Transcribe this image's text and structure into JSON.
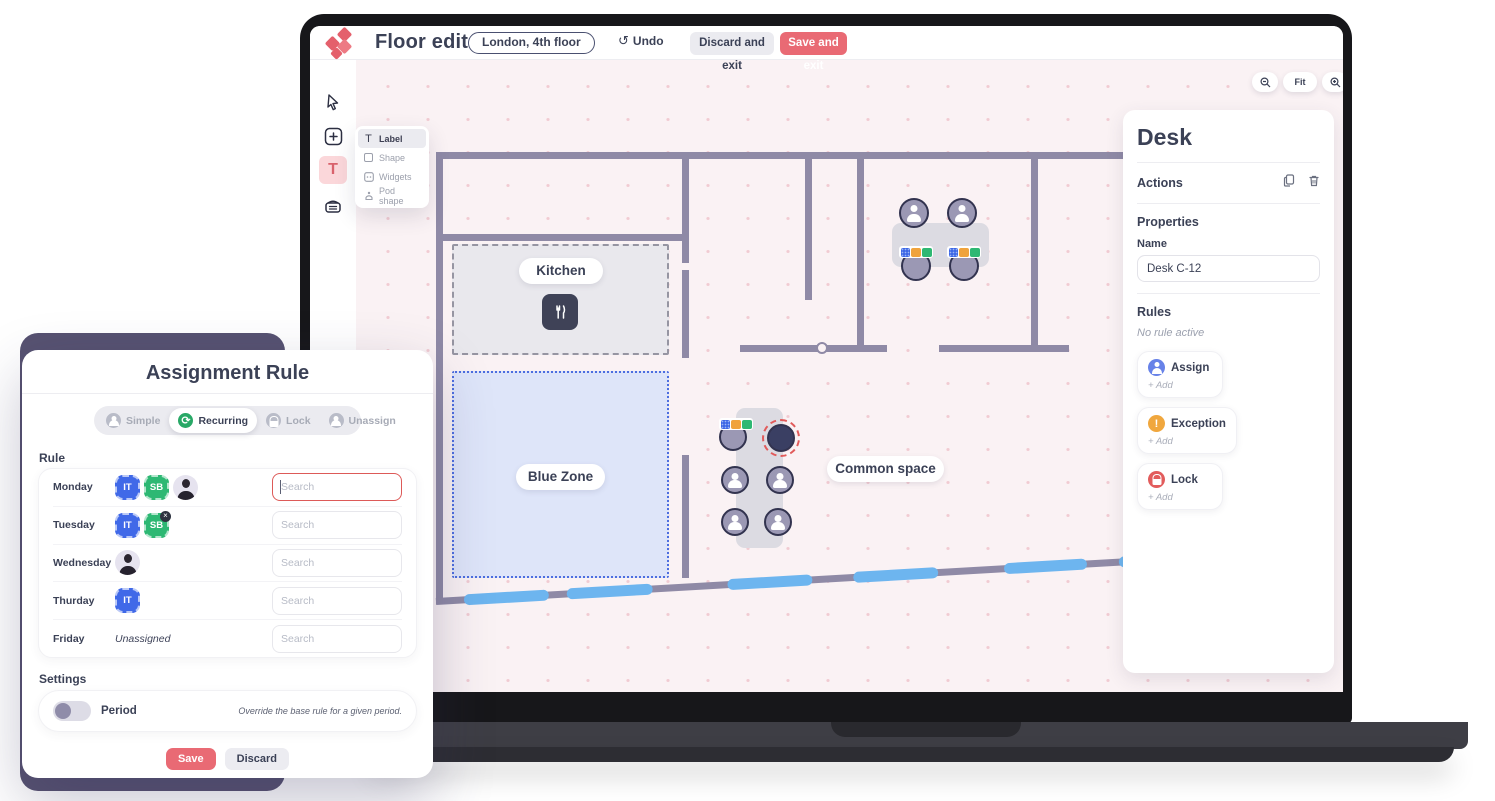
{
  "top_bar": {
    "title": "Floor editor",
    "location_pill": "London, 4th floor",
    "undo_label": "Undo",
    "discard_label": "Discard and exit",
    "save_label": "Save and exit"
  },
  "flyout": {
    "items": [
      {
        "label": "Label"
      },
      {
        "label": "Shape"
      },
      {
        "label": "Widgets"
      },
      {
        "label": "Pod shape"
      }
    ]
  },
  "canvas": {
    "kitchen_label": "Kitchen",
    "blue_zone_label": "Blue Zone",
    "common_space_label": "Common space",
    "zoom": {
      "fit_label": "Fit"
    }
  },
  "panel": {
    "title": "Desk",
    "actions_label": "Actions",
    "properties_label": "Properties",
    "name_label": "Name",
    "name_value": "Desk C-12",
    "rules_label": "Rules",
    "no_rule_text": "No rule active",
    "rule_buttons": [
      {
        "label": "Assign",
        "add_label": "+ Add"
      },
      {
        "label": "Exception",
        "add_label": "+ Add"
      },
      {
        "label": "Lock",
        "add_label": "+ Add"
      }
    ]
  },
  "modal": {
    "title": "Assignment Rule",
    "tabs": [
      {
        "label": "Simple",
        "active": false
      },
      {
        "label": "Recurring",
        "active": true
      },
      {
        "label": "Lock",
        "active": false
      },
      {
        "label": "Unassign",
        "active": false
      }
    ],
    "rule_heading": "Rule",
    "search_placeholder": "Search",
    "rows": [
      {
        "day": "Monday",
        "chips": [
          {
            "text": "IT"
          },
          {
            "text": "SB"
          },
          {
            "type": "avatar"
          }
        ]
      },
      {
        "day": "Tuesday",
        "chips": [
          {
            "text": "IT"
          },
          {
            "text": "SB",
            "removable": true
          }
        ]
      },
      {
        "day": "Wednesday",
        "chips": [
          {
            "type": "avatar"
          }
        ]
      },
      {
        "day": "Thurday",
        "chips": [
          {
            "text": "IT"
          }
        ]
      },
      {
        "day": "Friday",
        "chips": [],
        "empty_text": "Unassigned"
      }
    ],
    "close_badge": "×",
    "settings_heading": "Settings",
    "period_label": "Period",
    "period_hint": "Override the base rule for a given period.",
    "save_label": "Save",
    "discard_label": "Discard"
  },
  "colors": {
    "accent_red": "#e96a74",
    "badge_blue": "#4069e8",
    "badge_green": "#2db873",
    "assign_blue": "#6782e8",
    "exception_orange": "#f0a73e",
    "lock_red": "#e25c5c",
    "recurring_green": "#28a866",
    "wall": "#8f8aa6",
    "window_blue": "#6db5ef",
    "canvas_bg": "#faf2f4",
    "blue_zone_bg": "#dfe5fa",
    "selected_ring": "#e15b5b"
  }
}
